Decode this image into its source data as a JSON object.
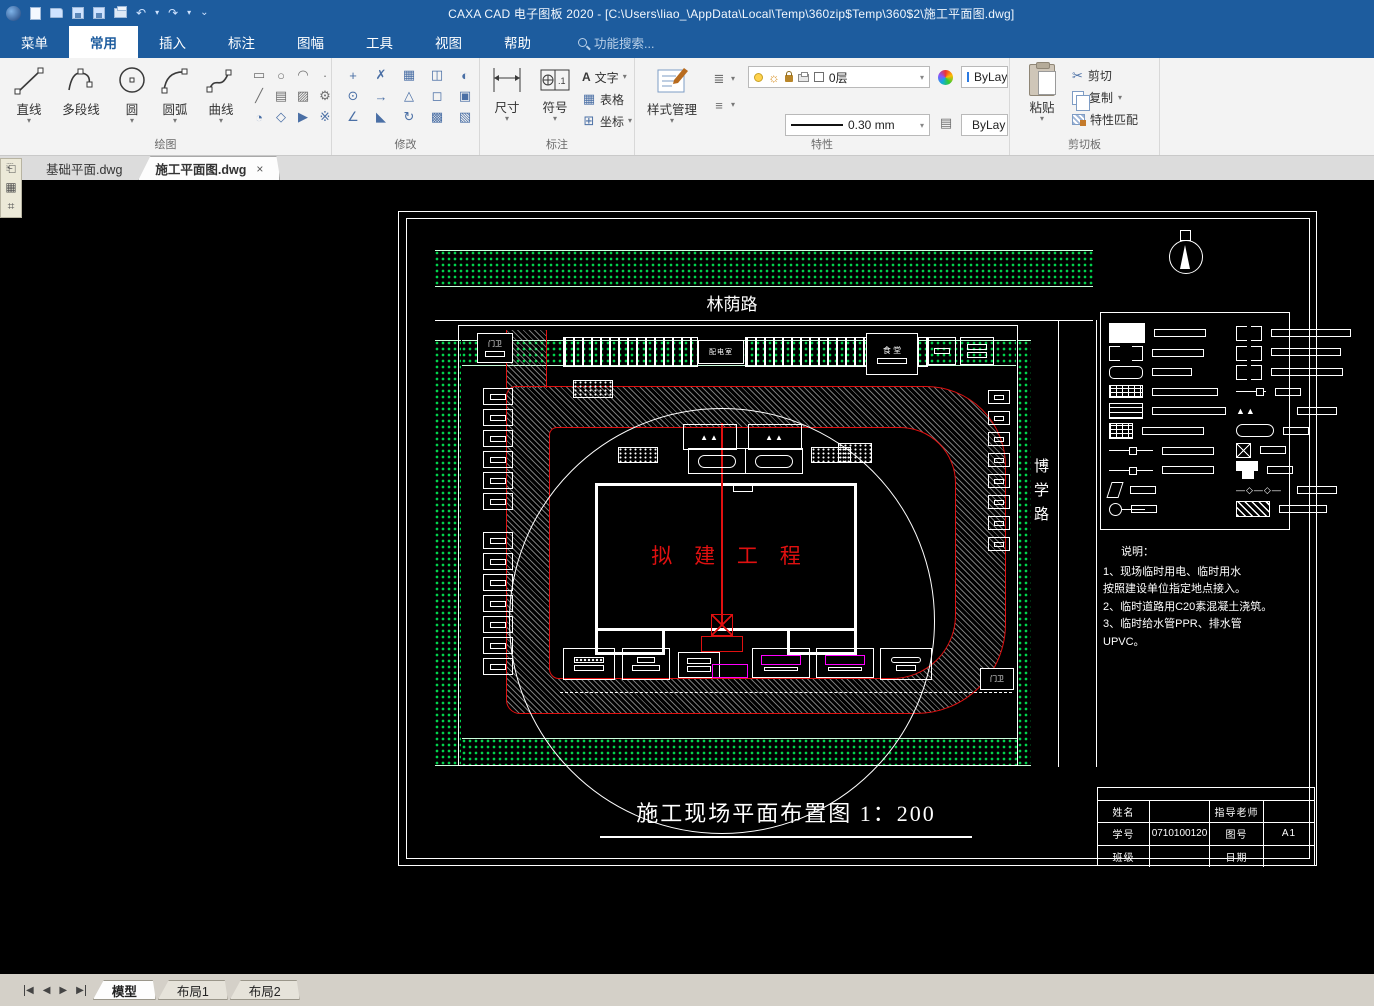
{
  "titlebar": {
    "title": "CAXA CAD 电子图板 2020 - [C:\\Users\\liao_\\AppData\\Local\\Temp\\360zip$Temp\\360$2\\施工平面图.dwg]"
  },
  "icons": {
    "undo": "↶",
    "redo": "↷",
    "dropdown": "▾",
    "overflow": "⌄",
    "close": "×",
    "cut": "✂",
    "menu_lines": "≡",
    "sun": "☼",
    "nav_first": "◀",
    "nav_prev": "◀",
    "nav_next": "▶",
    "nav_last": "▶",
    "draw_small": [
      "▭",
      "○",
      "◠",
      "·",
      "╱",
      "▤",
      "▨",
      "⚙",
      "◔",
      "◇",
      "▶",
      "※"
    ],
    "modify_small": [
      "+",
      "✗",
      "▦",
      "◫",
      "◐",
      "⊙",
      "→",
      "△",
      "◻",
      "▣",
      "∠",
      "◣",
      "↻",
      "▩",
      "▧"
    ]
  },
  "menu": {
    "tabs": [
      "菜单",
      "常用",
      "插入",
      "标注",
      "图幅",
      "工具",
      "视图",
      "帮助"
    ],
    "active": "常用",
    "search": "功能搜索..."
  },
  "ribbon": {
    "draw": {
      "label": "绘图",
      "buttons": [
        "直线",
        "多段线",
        "圆",
        "圆弧",
        "曲线"
      ]
    },
    "modify": {
      "label": "修改"
    },
    "annotate": {
      "label": "标注",
      "dim": "尺寸",
      "symbol": "符号",
      "text": "文字",
      "table": "表格",
      "coord": "坐标"
    },
    "props": {
      "label": "特性",
      "style": "样式管理",
      "layer": "0层",
      "color": "ByLayer",
      "width": "0.30 mm",
      "linetype": "ByLay"
    },
    "clip": {
      "label": "剪切板",
      "paste": "粘贴",
      "cut": "剪切",
      "copy": "复制",
      "match": "特性匹配"
    }
  },
  "doc_tabs": [
    {
      "label": "基础平面.dwg"
    },
    {
      "label": "施工平面图.dwg"
    }
  ],
  "drawing": {
    "road_top": "林荫路",
    "road_right": "博学路",
    "building": "拟 建 工 程",
    "caption": "施工现场平面布置图 1：200",
    "power_room": "配电室",
    "canteen": "食 堂",
    "guard1": "门卫",
    "guard2": "门卫",
    "notes": {
      "title": "说明：",
      "line1": "1、现场临时用电、临时用水",
      "line2": "按照建设单位指定地点接入。",
      "line3": "2、临时道路用C20素混凝土浇筑。",
      "line4": "3、临时给水管PPR、排水管",
      "line5": "UPVC。"
    },
    "titleblock": {
      "name": "姓名",
      "advisor": "指导老师",
      "sid": "学号",
      "sid_val": "0710100120",
      "fig": "图号",
      "fig_val": "A1",
      "cls": "班级",
      "date": "日期"
    }
  },
  "statusbar": {
    "sheets": [
      "模型",
      "布局1",
      "布局2"
    ],
    "active": "模型"
  },
  "colors": {
    "titlebar": "#1d5c9e",
    "green": "#00d24b",
    "red": "#ff0000",
    "magenta": "#ff00ff"
  }
}
